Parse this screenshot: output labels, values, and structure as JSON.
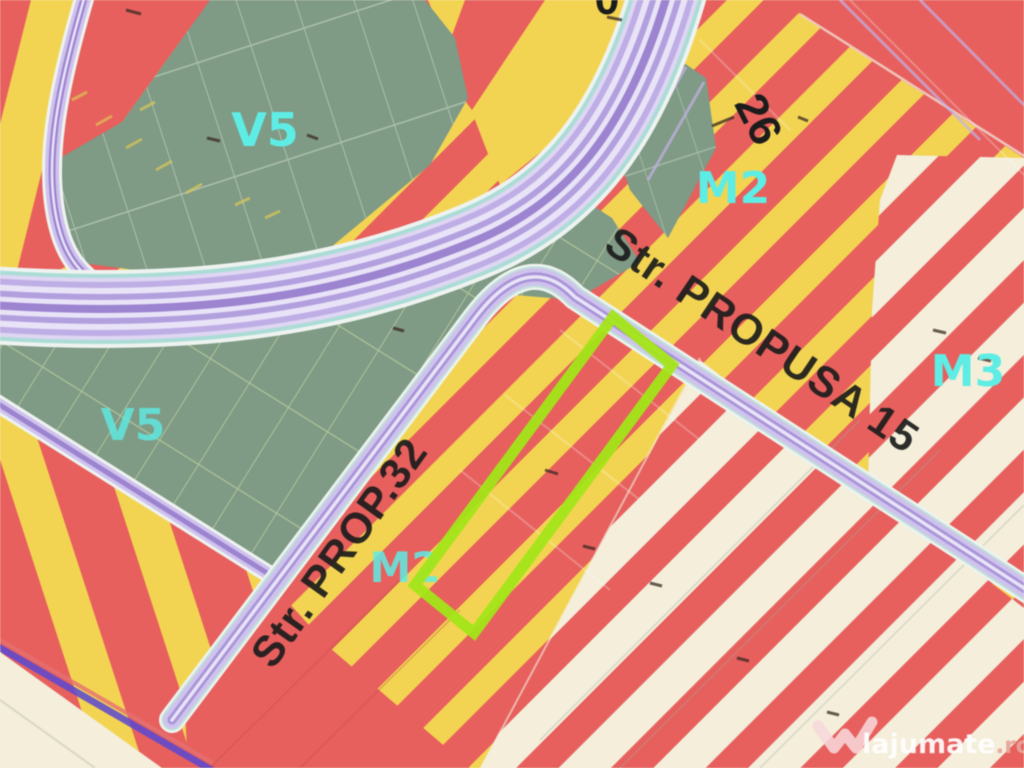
{
  "labels": {
    "v5_upper": "V5",
    "v5_lower": "V5",
    "m2_upper": "M2",
    "m2_center": "M2",
    "m3": "M3",
    "parcel_26": "26",
    "top_partial_digit": "0",
    "str_propusa_15": "Str. PROPUSA 15",
    "str_prop_32": "Str. PROP.32"
  },
  "watermark": {
    "brand": "lajumate",
    "tld": ".ro"
  },
  "colors": {
    "red": "#ea5f5c",
    "yellow": "#f4d44e",
    "cream": "#f4eeda",
    "sage_green": "#7e9a85",
    "cyan_label": "#5beee6",
    "black_label": "#1c1c1c",
    "road_lavender": "#cfc2ee",
    "road_violet": "#9c84d2",
    "road_light": "#e9e3f8",
    "road_teal": "#aadcd6",
    "road_casing": "#eef3f0",
    "hatch_green": "#cfe0a4",
    "hatch_white": "#d9e6d4",
    "indigo_line": "#5a48d6",
    "highlight_green": "#a2e613",
    "watermark_white": "#ffffff",
    "watermark_pink": "#eaa49a",
    "logo_pink": "#f8d7da"
  }
}
